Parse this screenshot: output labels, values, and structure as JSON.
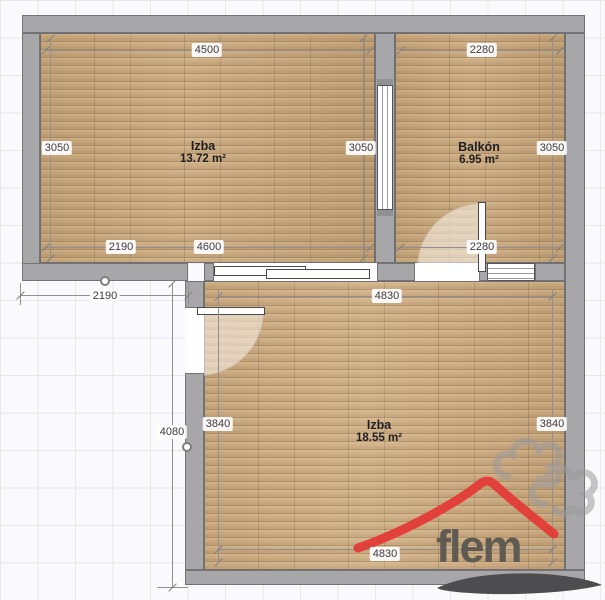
{
  "plan": {
    "rooms": {
      "room1": {
        "name": "Izba",
        "area": "13.72 m²"
      },
      "balcony": {
        "name": "Balkón",
        "area": "6.95 m²"
      },
      "room2": {
        "name": "Izba",
        "area": "18.55 m²"
      }
    },
    "dims": {
      "room1_top": "4500",
      "room1_left": "3050",
      "room1_right": "3050",
      "room1_bottom_left": "2190",
      "room1_bottom_right": "4600",
      "balcony_top": "2280",
      "balcony_right": "3050",
      "balcony_bottom": "2280",
      "room2_top": "4830",
      "room2_left": "3840",
      "room2_right": "3840",
      "room2_bottom": "4830",
      "exterior_width": "2190",
      "exterior_height": "4080"
    }
  },
  "logo": {
    "brand": "flem"
  },
  "colors": {
    "wall": "#a7a7a9",
    "wood": "#c9a87d",
    "roof_red": "#e2403a",
    "logo_text": "#5f5b52"
  }
}
